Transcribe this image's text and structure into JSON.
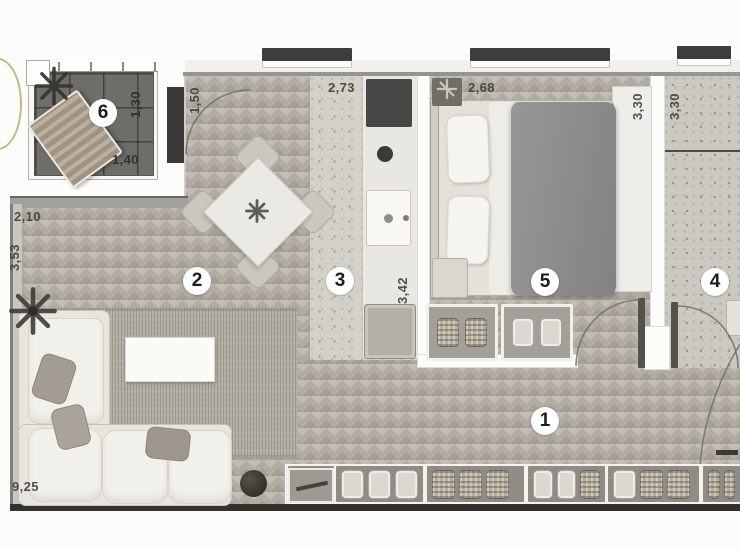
{
  "plan": {
    "type": "apartment-floor-plan",
    "room_labels": {
      "hallway": "1",
      "living_room": "2",
      "kitchen": "3",
      "bathroom": "4",
      "bedroom": "5",
      "balcony": "6"
    },
    "dimensions": {
      "balcony_depth": "1,30",
      "balcony_width": "1,40",
      "balcony_door": "1,50",
      "living_top": "2,73",
      "kitchen_length": "3,42",
      "bedroom_width": "2,68",
      "bedroom_depth": "3,30",
      "bathroom_depth": "3,30",
      "living_left_width": "2,10",
      "living_left_depth": "3,53",
      "total_width": "9,25"
    },
    "colors": {
      "wood_floor": "#b1aca3",
      "concrete_floor": "#d3d0ca",
      "balcony_floor": "#6e6d69",
      "blanket_gray": "#8d8d8d",
      "logo_olive": "#b2aa63"
    }
  }
}
